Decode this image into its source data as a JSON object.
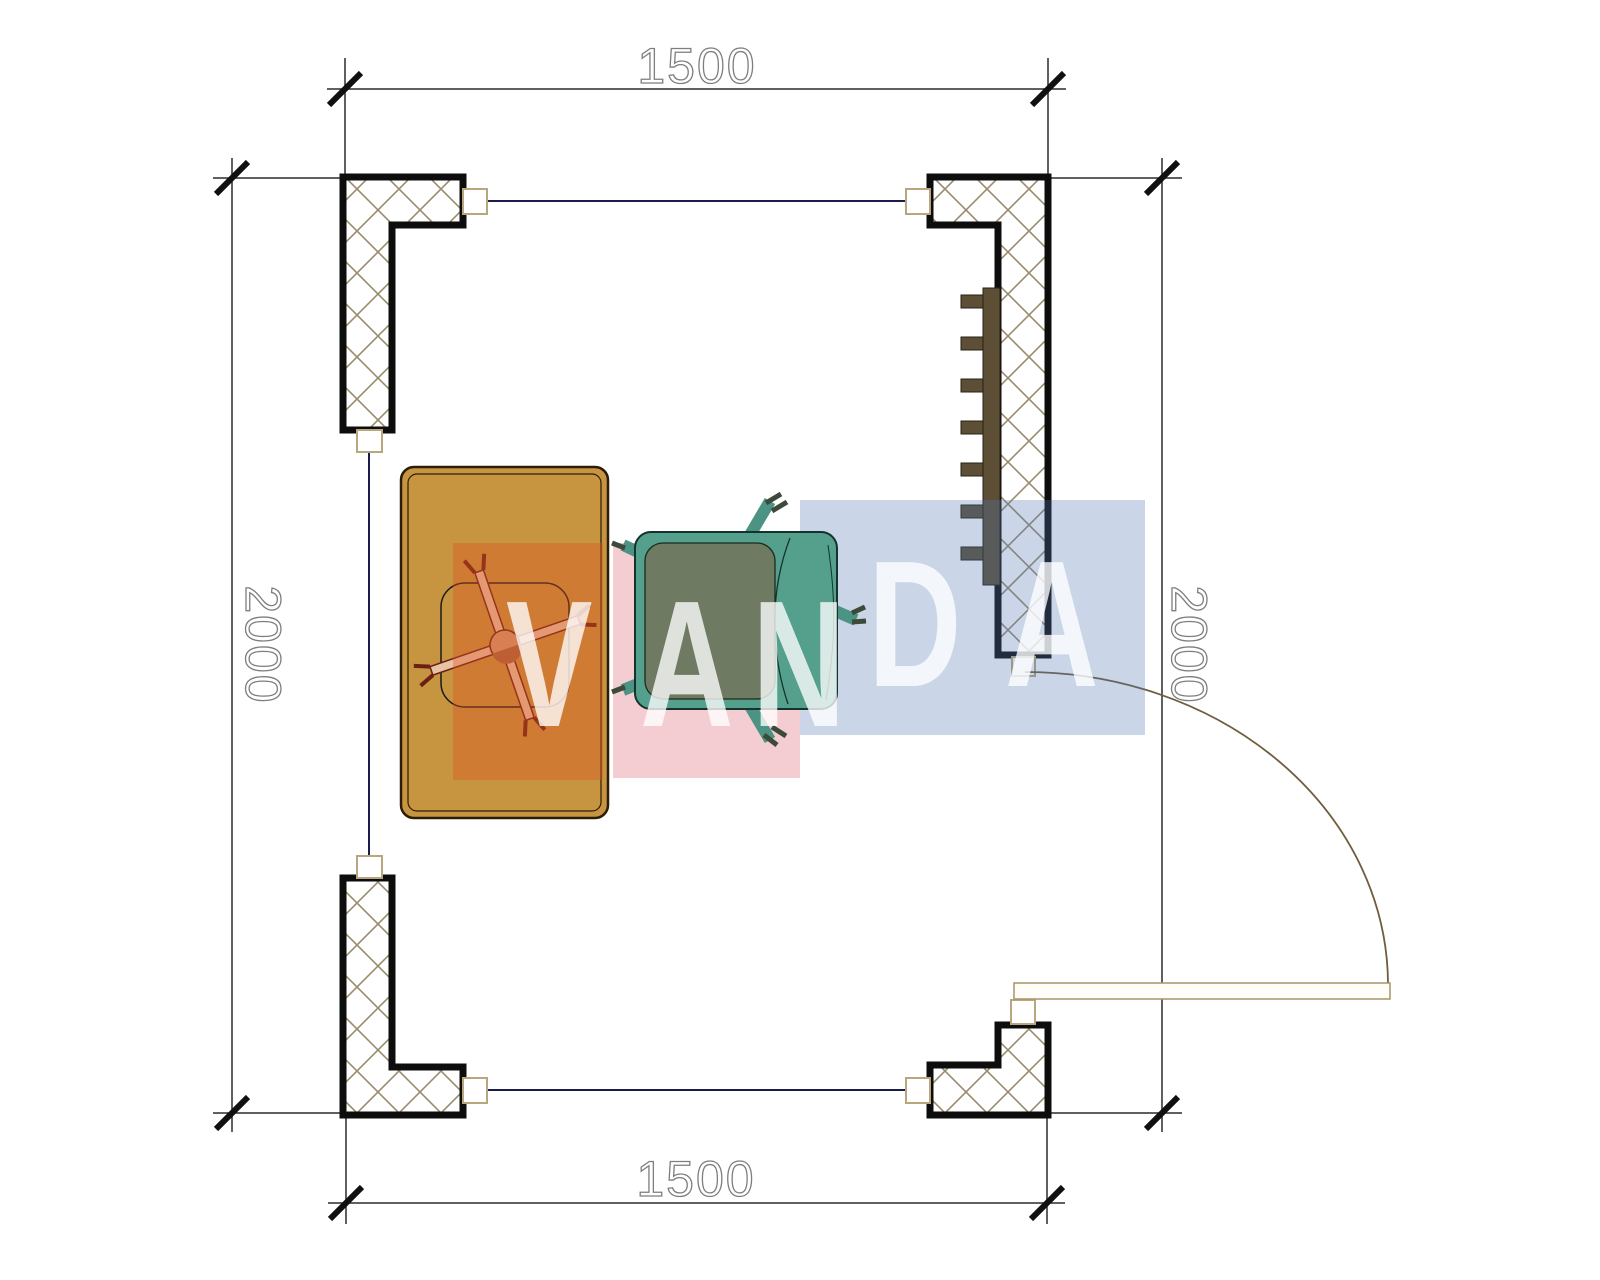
{
  "plan": {
    "dimensions": {
      "top": "1500",
      "bottom": "1500",
      "left": "2000",
      "right": "2000"
    },
    "watermark": {
      "letters": [
        "V",
        "A",
        "N",
        "D",
        "A"
      ]
    },
    "colors": {
      "desk": "#c79440",
      "desk_chair_base": "#e7c3a4",
      "armchair_body": "#55a08c",
      "armchair_seat": "#6e7a62",
      "armchair_leg": "#4c9383",
      "radiator": "#5c4f36",
      "block_orange": "rgba(223,83,34,0.38)",
      "block_pink": "rgba(214,70,90,0.27)",
      "block_blue": "rgba(80,118,176,0.30)",
      "wall_outline": "#0d0d0d",
      "hatch_line": "#9a8b6f",
      "window_line": "#1b1b4f",
      "door_line": "#6f5d3e"
    }
  }
}
